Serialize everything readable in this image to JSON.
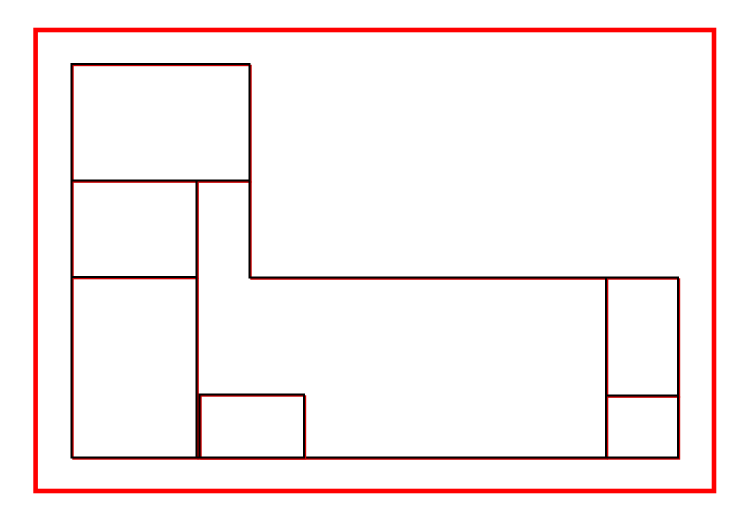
{
  "canvas": {
    "width": 749,
    "height": 525,
    "background": "#ffffff"
  },
  "colors": {
    "container_stroke": "#ff0000",
    "piece_stroke": "#000000",
    "overlay_stroke": "#cc0000"
  },
  "container": {
    "name": "outer-boundary",
    "x": 35.6,
    "y": 30,
    "width": 678.4,
    "height": 461,
    "stroke_width": 4.6
  },
  "piece_style": {
    "stroke_width": 2,
    "overlay_stroke_width": 1.4,
    "overlay_offset_x": 1.5,
    "overlay_offset_y": 1.5
  },
  "pieces": [
    {
      "name": "piece-top-left",
      "type": "rect",
      "x": 71.5,
      "y": 64,
      "w": 178,
      "h": 116.5
    },
    {
      "name": "piece-left-middle",
      "type": "rect",
      "x": 71.5,
      "y": 180.5,
      "w": 125,
      "h": 96.5
    },
    {
      "name": "piece-left-tall",
      "type": "rect",
      "x": 71.5,
      "y": 277,
      "w": 125,
      "h": 180.5
    },
    {
      "name": "region-l-shape",
      "type": "polygon",
      "points": [
        [
          196.5,
          180.5
        ],
        [
          249.5,
          180.5
        ],
        [
          249.5,
          277.5
        ],
        [
          606,
          277.5
        ],
        [
          606,
          457.5
        ],
        [
          196.5,
          457.5
        ]
      ]
    },
    {
      "name": "piece-bottom-small",
      "type": "rect",
      "x": 199.5,
      "y": 394.5,
      "w": 104.5,
      "h": 63
    },
    {
      "name": "piece-right-top",
      "type": "rect",
      "x": 606,
      "y": 277.5,
      "w": 72,
      "h": 118
    },
    {
      "name": "piece-right-bottom",
      "type": "rect",
      "x": 606,
      "y": 395.5,
      "w": 72,
      "h": 62
    }
  ]
}
